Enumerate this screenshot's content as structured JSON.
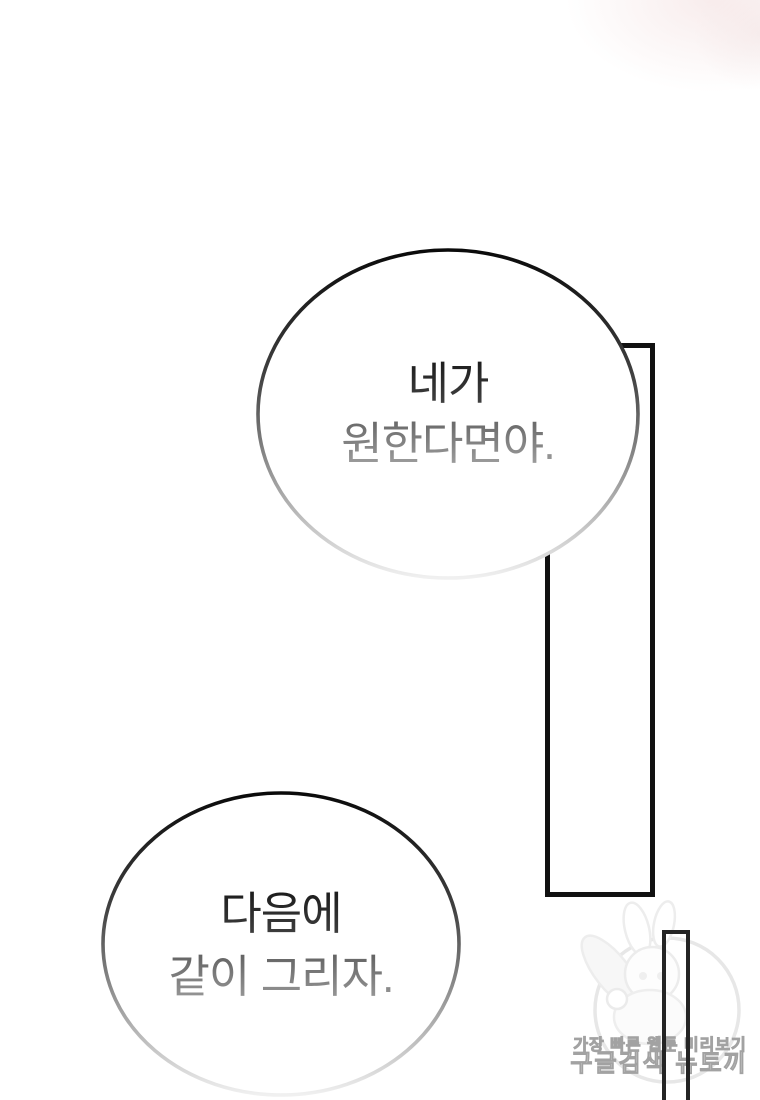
{
  "page_kind": "webtoon-comic-panel",
  "speech_bubbles": [
    {
      "lines": [
        "네가",
        "원한다면야."
      ]
    },
    {
      "lines": [
        "다음에",
        "같이 그리자."
      ]
    }
  ],
  "watermark": {
    "tagline": "가장 빠른 웹툰 미리보기",
    "brand": "구글검색 뉴토끼"
  },
  "colors": {
    "background": "#ffffff",
    "panel_frame_stroke": "#111111",
    "narrow_frame_stroke": "#242424",
    "bubble_stroke_top": "#0a0a0a",
    "bubble_stroke_mid": "#9c9c9c",
    "bubble_stroke_bottom": "#f0f0f0",
    "text_dark": "#2f2f2f",
    "text_faded": "#8b8b8b",
    "watermark_outline": "#a2a2a2",
    "watermark_art": "#ececec",
    "top_remnant_tint": "#f2dddd"
  }
}
